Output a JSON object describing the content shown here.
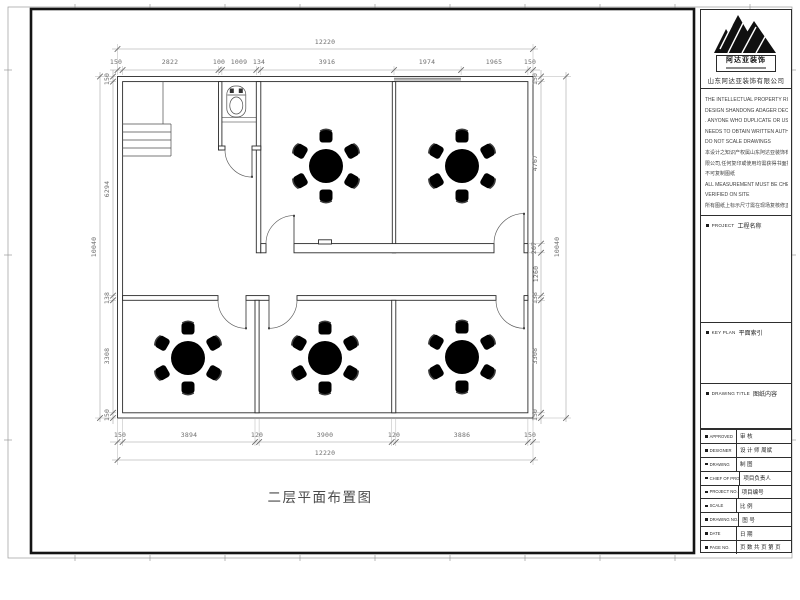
{
  "sheet": {
    "drawing_title": "二层平面布置图"
  },
  "title_block": {
    "logo_text": "阿达亚装饰",
    "company_cn": "山东阿达亚装饰有限公司",
    "disclaimer_lines": [
      "THE INTELLECTUAL PROPERTY RIGHT OF THIS",
      "DESIGN SHANDONG ADAGER DECORATION CO.,LTD",
      ". ANYONE WHO DUPLICATE OR USE",
      "NEEDS TO OBTAIN WRITTEN AUTHORIZATION",
      "DO NOT SCALE DRAWINGS",
      "本设计之知识产权属山东阿达亚装饰有",
      "限公司,任何复印或使用均需获得书面授权.",
      "不可复制图纸",
      "ALL MEASUREMENT MUST BE CHECKED AND",
      "VERIFIED ON SITE",
      "所有图纸上标示尺寸需在现场复核修正"
    ],
    "sections": [
      {
        "label_en": "PROJECT",
        "label_cn": "工程名称"
      },
      {
        "label_en": "KEY PLAN",
        "label_cn": "平面索引"
      },
      {
        "label_en": "DRAWING TITLE",
        "label_cn": "图纸内容"
      }
    ],
    "rows": [
      {
        "label": "APPROVED",
        "value": "审  核"
      },
      {
        "label": "DESIGNER",
        "value": "设 计 师   周斌"
      },
      {
        "label": "DRAWING",
        "value": "制  图"
      },
      {
        "label": "CHIEF OF PRO",
        "value": "项目负责人"
      },
      {
        "label": "PROJECT NO.",
        "value": "项目编号"
      },
      {
        "label": "SCALE",
        "value": "比  例"
      },
      {
        "label": "DRAWING NO.",
        "value": "图  号"
      },
      {
        "label": "DATE",
        "value": "日  期"
      },
      {
        "label": "PAGE NO.",
        "value": "页  数 共   页 第   页"
      }
    ]
  },
  "dimensions": {
    "top_overall": "12220",
    "top_segments": [
      "150",
      "2822",
      "100",
      "1009",
      "134",
      "3916",
      "1974",
      "1965",
      "150"
    ],
    "bottom_segments": [
      "150",
      "3894",
      "120",
      "3900",
      "120",
      "3886",
      "150"
    ],
    "bottom_overall": "12220",
    "left_segments": [
      "150",
      "6294",
      "138",
      "3308",
      "150"
    ],
    "left_overall": "10040",
    "right_segments": [
      "150",
      "4767",
      "267",
      "1260",
      "138",
      "3308",
      "150"
    ],
    "right_overall": "10040"
  }
}
